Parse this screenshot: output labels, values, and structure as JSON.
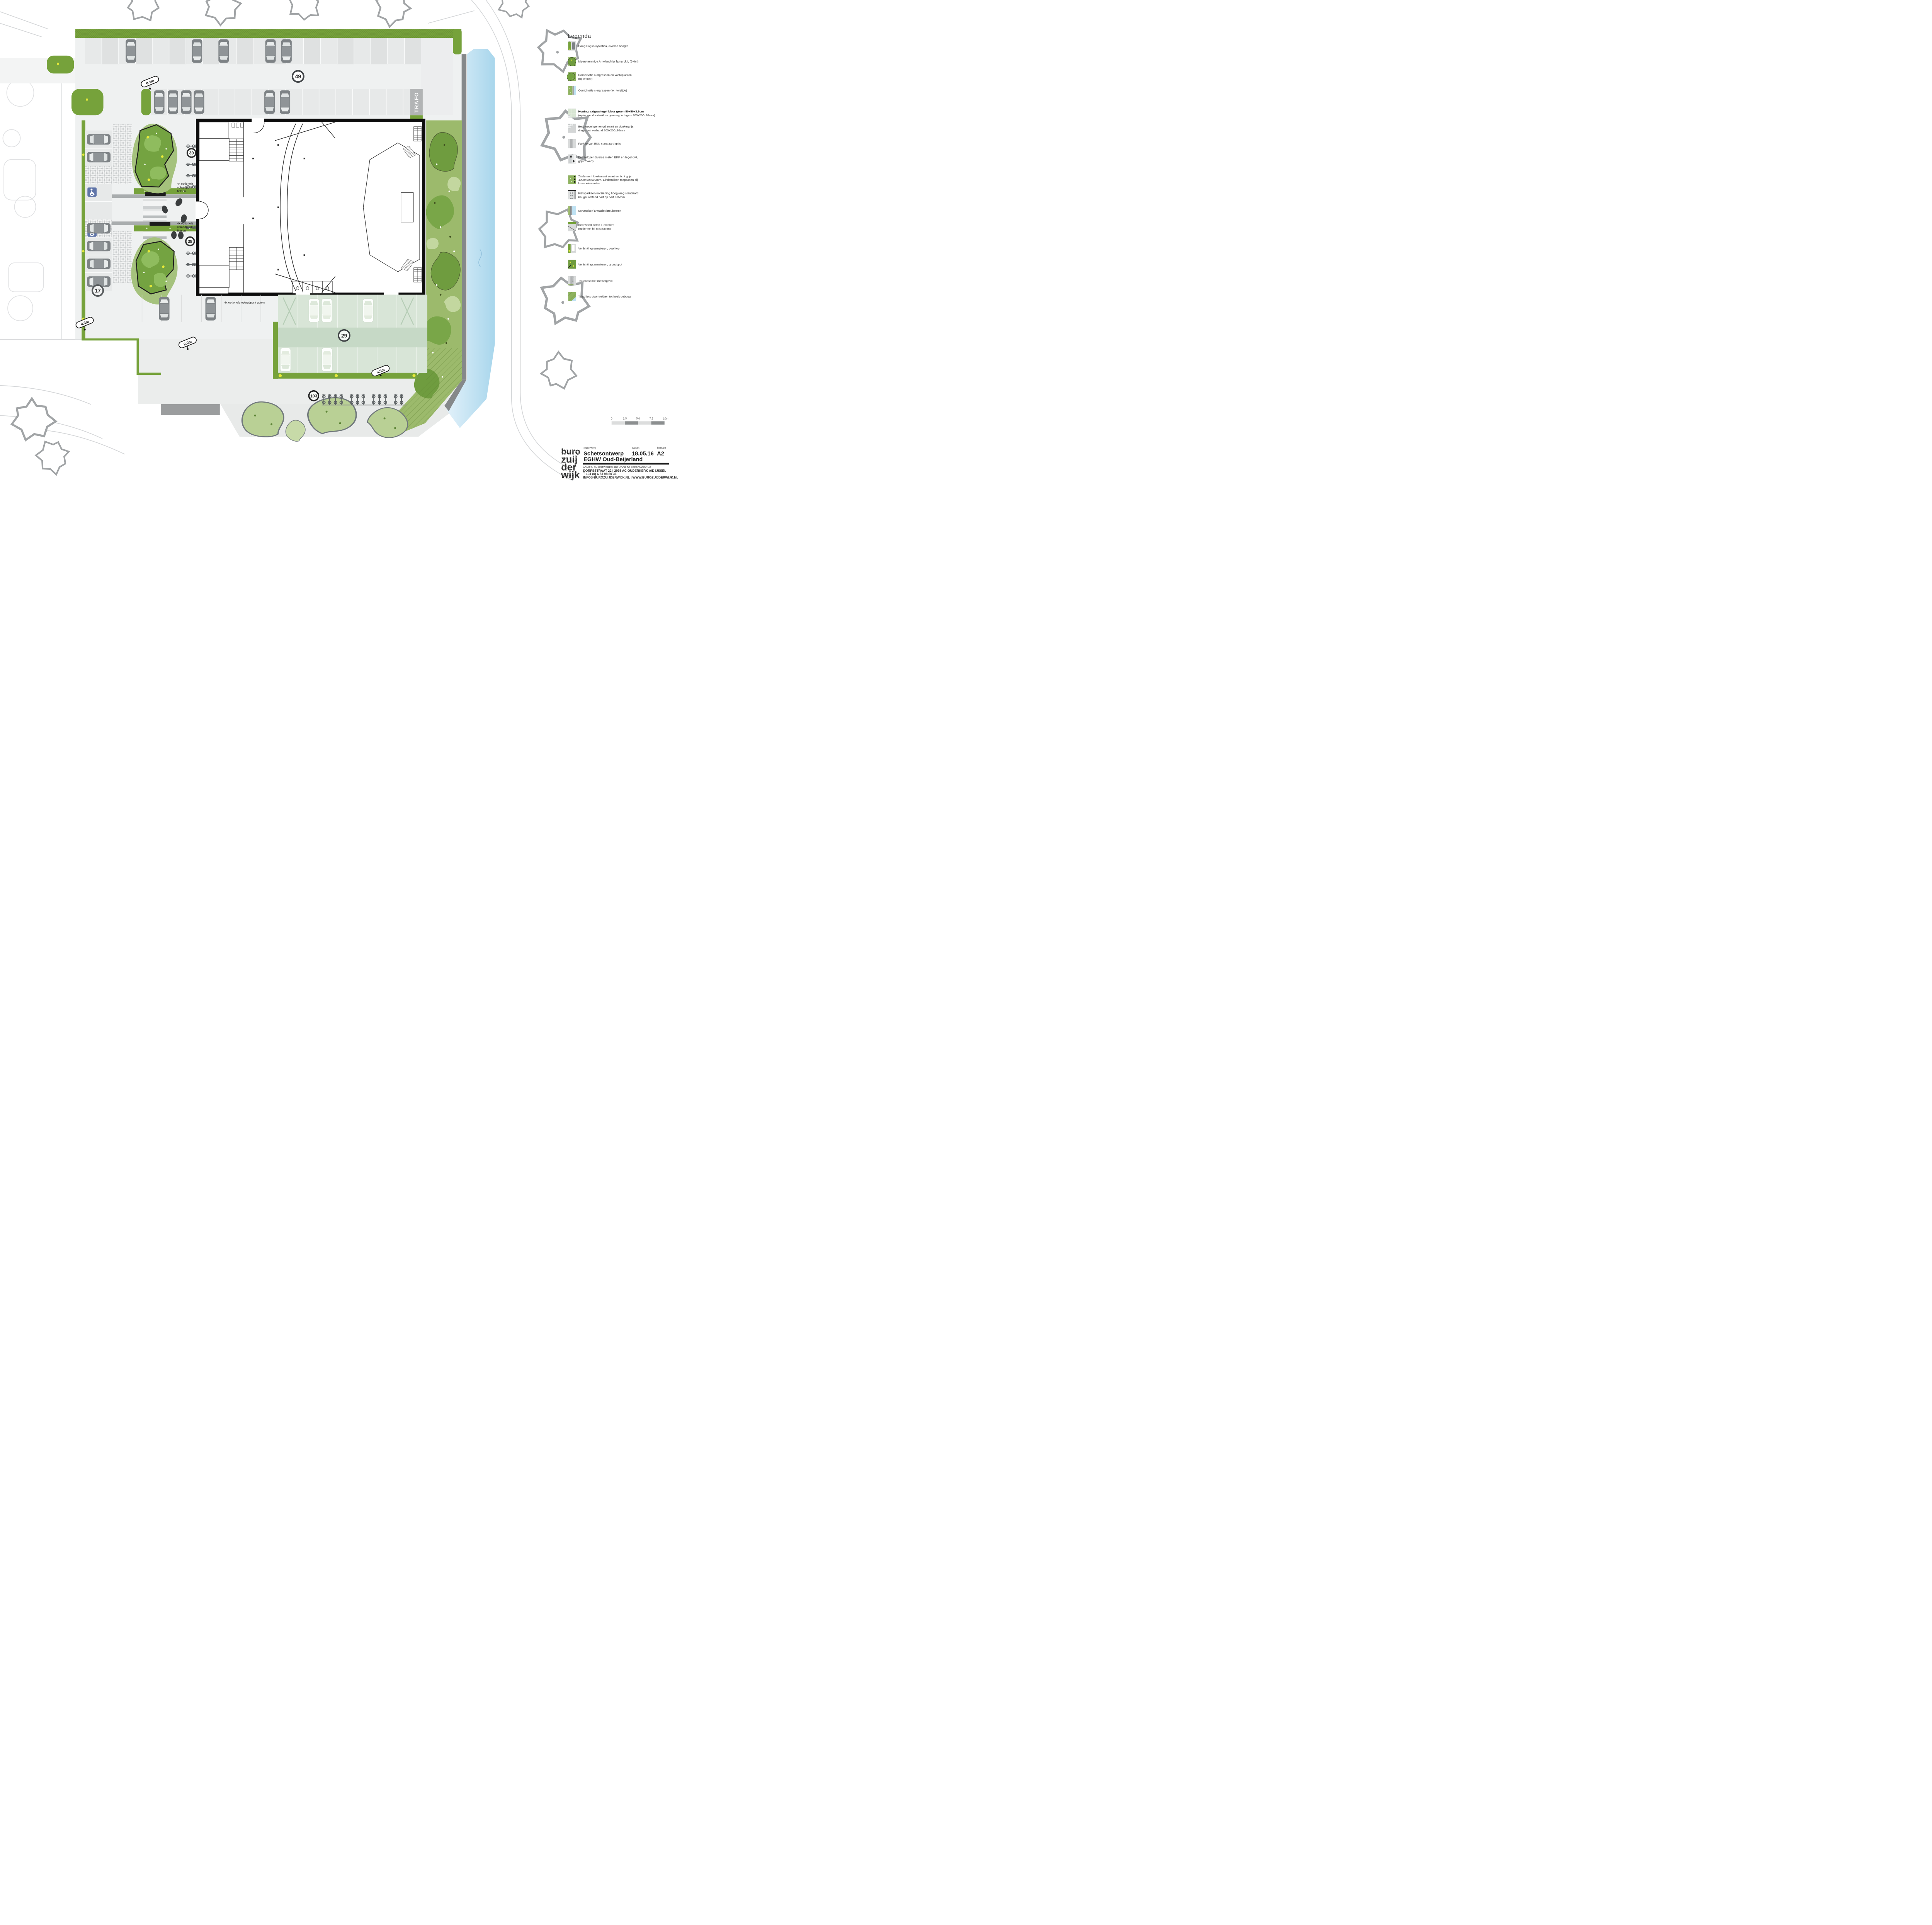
{
  "legend": {
    "title": "Legenda",
    "items": [
      {
        "lines": [
          "Haag Fagus sylvatica, diverse hoogte"
        ]
      },
      {
        "lines": [
          "Meerstammige Amelanchier lamarckii, (5-6m)"
        ]
      },
      {
        "lines": [
          "Combinatie siergrassen en vasteplanten",
          "(bij entree)"
        ]
      },
      {
        "lines": [
          "Combinatie siergrassen (achterzijde)"
        ]
      },
      {
        "lines": [
          "Honingraatgrastegel kleur groen 50x50x3.8cm",
          "(optioneel doortrekken gemengde tegels 200x200x80mm)"
        ]
      },
      {
        "lines": [
          "Betontegel gemengd zwart en donkergrijs",
          "diagonaal verband 200x200x80mm"
        ]
      },
      {
        "lines": [
          "Parkeervak BKK standaard grijs"
        ]
      },
      {
        "lines": [
          "Entreeloper diverse maten BKK en tegel (wit,",
          "grijs, zwart)"
        ]
      },
      {
        "lines": [
          "Zitelement U-element zwart en licht grijs",
          "400x400x500mm. Eindstukken toepassen bij",
          "losse elementen."
        ]
      },
      {
        "lines": [
          "Fietsparkeervoorziening hoog-laag standaard",
          "beugel afstand hart op hart 375mm"
        ]
      },
      {
        "lines": [
          "Schanskorf antraciet breuksteen"
        ]
      },
      {
        "lines": [
          "Keerwand  beton L-element",
          "(optioneel bij gasstation)"
        ]
      },
      {
        "lines": [
          "Verlichtingsarmaturen, paal top"
        ]
      },
      {
        "lines": [
          "Verlichtingsarmaturen, grondspot"
        ]
      },
      {
        "lines": [
          "Trafokast met metselgevel"
        ]
      },
      {
        "lines": [
          "Talud iets door trekken tot hoek gebouw"
        ]
      }
    ]
  },
  "plan": {
    "badges": {
      "parking_top": "49",
      "bikes_north": "39",
      "bikes_south": "38",
      "parking_left": "17",
      "parking_green": "29",
      "bikes_total": "103"
    },
    "labels": {
      "trafo": "TRAFO",
      "bike_charging_lines": [
        "4x optionele",
        "oplaadpunt",
        "fietsen"
      ],
      "car_charging": "4x optionele oplaadpunt auto's"
    },
    "dimensions": {
      "hedge_top": "0.5m",
      "hedge_left": "0.5m",
      "path_width": "2.0m",
      "hedge_south": "0.5m"
    }
  },
  "scale_bar": {
    "ticks": [
      "0",
      "2.5",
      "5.0",
      "7.5",
      "10m"
    ]
  },
  "title_block": {
    "logo_lines": [
      "buro",
      "zuij",
      "der",
      "wijk"
    ],
    "subject_label": "onderwerp",
    "subject_line1": "Schetsontwerp",
    "subject_line2": "EGHW Oud-Beijerland",
    "date_label": "datum",
    "date_value": "18.05.16",
    "format_label": "formaat",
    "format_value": "A2",
    "tagline": "ADVIES- EN ONTWERPBURO VOOR DE LEEFOMGEVING",
    "address": "DORPSSTRAAT 22 | 2935 AC OUDERKERK A/D IJSSEL",
    "phone": "T +31 (0) 6 53 98 80 36",
    "contact": "INFO@BUROZUIJDERWIJK.NL | WWW.BUROZUIJDERWIJK.NL"
  },
  "colors": {
    "hedge_green": "#76a23b",
    "planting_green": "#6f9c3f",
    "light_planting": "#9cba6c",
    "water_blue": "#bfe2f4",
    "wall_gray": "#85888a",
    "accent_yellow": "#e6ea39",
    "disabled_blue": "#5f74a8",
    "building_outline": "#0d0d0d"
  }
}
